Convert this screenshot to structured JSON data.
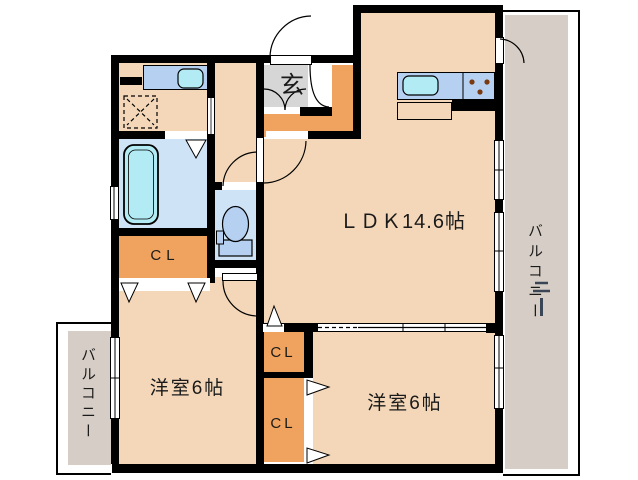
{
  "labels": {
    "ldk": "ＬＤＫ14.6帖",
    "western_room_1": "洋室6帖",
    "western_room_2": "洋室6帖",
    "closet_bath": "CL",
    "closet_mid_upper": "CL",
    "closet_mid_lower": "CL",
    "entrance": "玄",
    "balcony_right": "バルコニー",
    "balcony_left": "バルコニー"
  },
  "colors": {
    "background": "#ffffff",
    "wall": "#000000",
    "floor": "#f3d7b8",
    "closet": "#f0a35e",
    "entrance_floor": "#d6d6d6",
    "balcony": "#d6cec6",
    "wet_floor": "#cfe3f6",
    "fixture": "#b5d0f0",
    "water": "#b2ebf4",
    "text": "#1a1a1a"
  }
}
